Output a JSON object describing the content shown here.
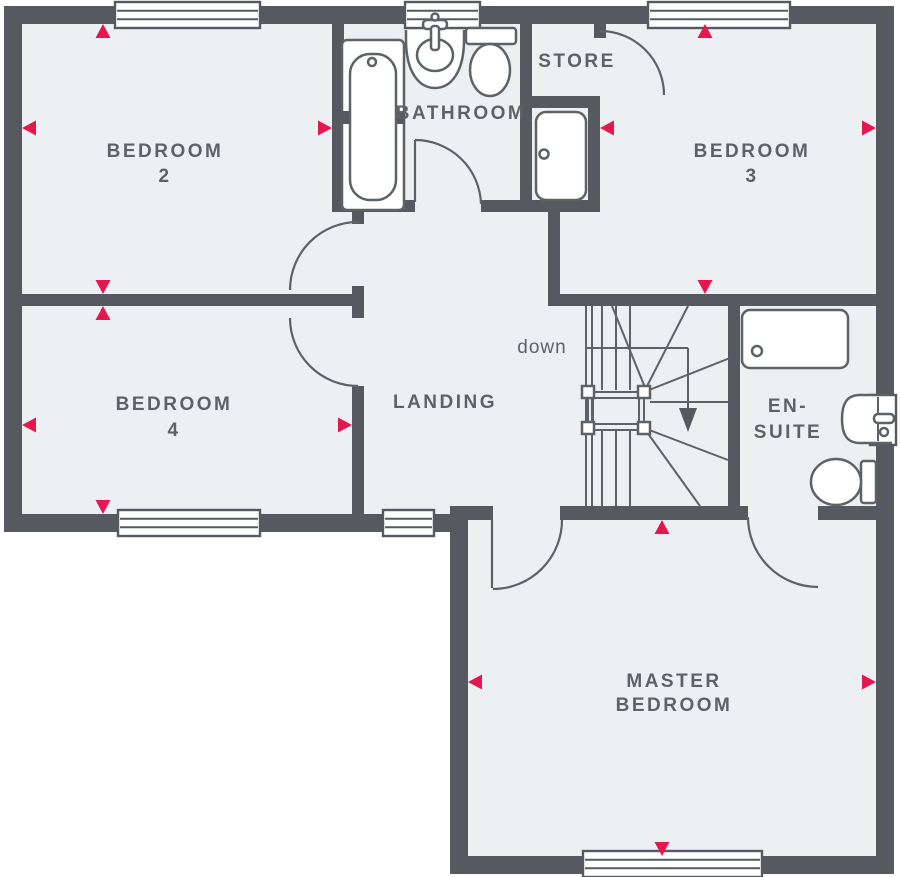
{
  "title": "Floor plan",
  "rooms": {
    "bedroom2": {
      "name": "BEDROOM",
      "number": "2"
    },
    "bedroom3": {
      "name": "BEDROOM",
      "number": "3"
    },
    "bedroom4": {
      "name": "BEDROOM",
      "number": "4"
    },
    "bathroom": {
      "name": "BATHROOM"
    },
    "store": {
      "name": "STORE"
    },
    "landing": {
      "name": "LANDING"
    },
    "ensuite": {
      "line1": "EN-",
      "line2": "SUITE"
    },
    "master": {
      "line1": "MASTER",
      "line2": "BEDROOM"
    }
  },
  "stairs": {
    "down_label": "down"
  },
  "icons": {
    "fixtures": [
      "bath-icon",
      "bathroom-sink-icon",
      "bathroom-toilet-icon",
      "cylinder-icon",
      "shower-icon",
      "ensuite-sink-icon",
      "ensuite-toilet-icon"
    ],
    "markers": "dimension-arrow"
  },
  "colors": {
    "wall": "#565a60",
    "floor": "#edf0f3",
    "marker": "#e6164e",
    "text": "#5d6267",
    "stroke": "#5d6267",
    "bg": "#ffffff"
  }
}
